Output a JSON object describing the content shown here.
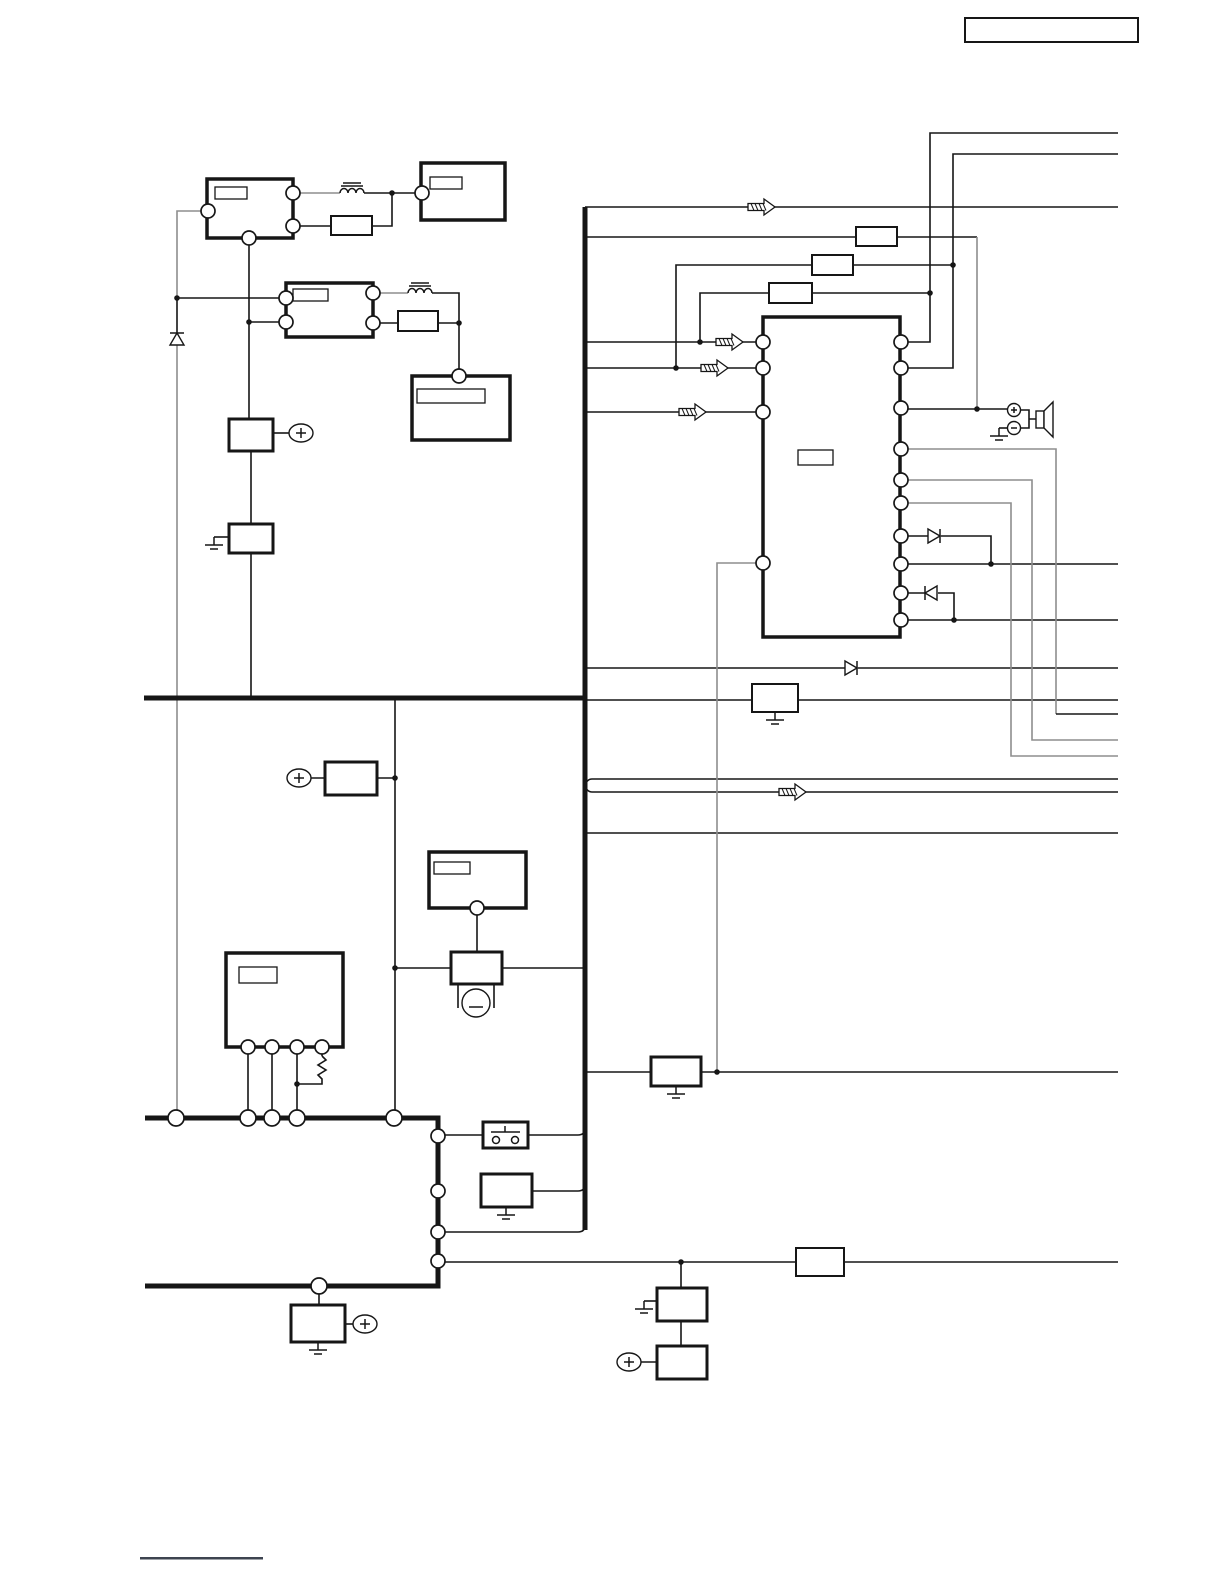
{
  "figure": {
    "kind": "circuit-schematic",
    "description_tokens": [
      "schematic page",
      "blank label boxes",
      "bus wiring"
    ],
    "text_labels": []
  },
  "colors": {
    "background": "#ffffff",
    "ink": "#161616",
    "muted": "#8e8e8e",
    "footer_rule": "#3d4450"
  },
  "symbols": [
    "component-box",
    "label-box",
    "resistor-box",
    "zigzag-resistor",
    "inductor",
    "diode",
    "ground",
    "terminal-circle",
    "junction-dot",
    "signal-flow-arrow",
    "speaker",
    "push-switch",
    "motor",
    "plus-source-ellipse",
    "minus-motor-circle",
    "title-box",
    "footer-rule"
  ]
}
